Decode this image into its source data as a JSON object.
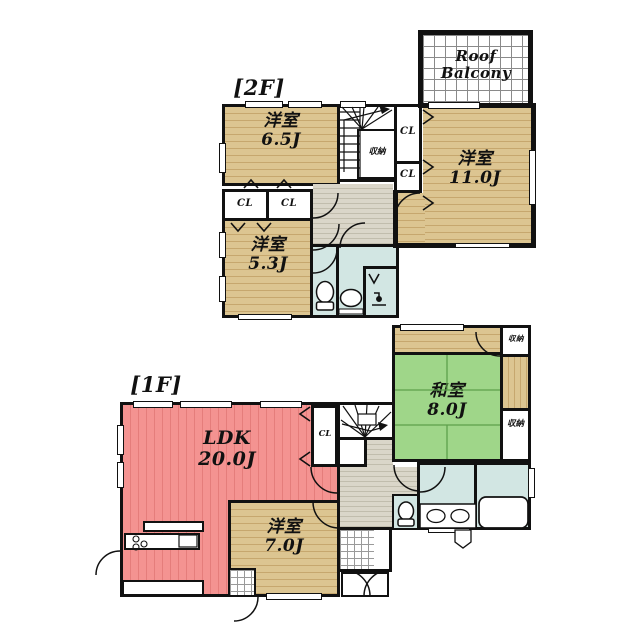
{
  "floor2": {
    "floor_label": "[2F]",
    "roof_balcony_label": "Roof Balcony",
    "room_65_name": "洋室",
    "room_65_size": "6.5J",
    "room_110_name": "洋室",
    "room_110_size": "11.0J",
    "room_53_name": "洋室",
    "room_53_size": "5.3J",
    "closet_label": "CL",
    "storage_label": "収納"
  },
  "floor1": {
    "floor_label": "[1F]",
    "ldk_name": "LDK",
    "ldk_size": "20.0J",
    "washitsu_name": "和室",
    "washitsu_size": "8.0J",
    "room_70_name": "洋室",
    "room_70_size": "7.0J",
    "closet_label": "CL",
    "storage_top_label": "収納",
    "storage_side_label": "収納"
  },
  "colors": {
    "wall": "#111111",
    "wood_floor": "#dcc591",
    "wood_stripe": "#c6a76e",
    "ldk_red": "#f49391",
    "ldk_stripe": "#e57d7b",
    "tatami_green": "#9fd689",
    "bath_blue": "#d2e6e3",
    "hall_gray": "#dad6c9"
  }
}
